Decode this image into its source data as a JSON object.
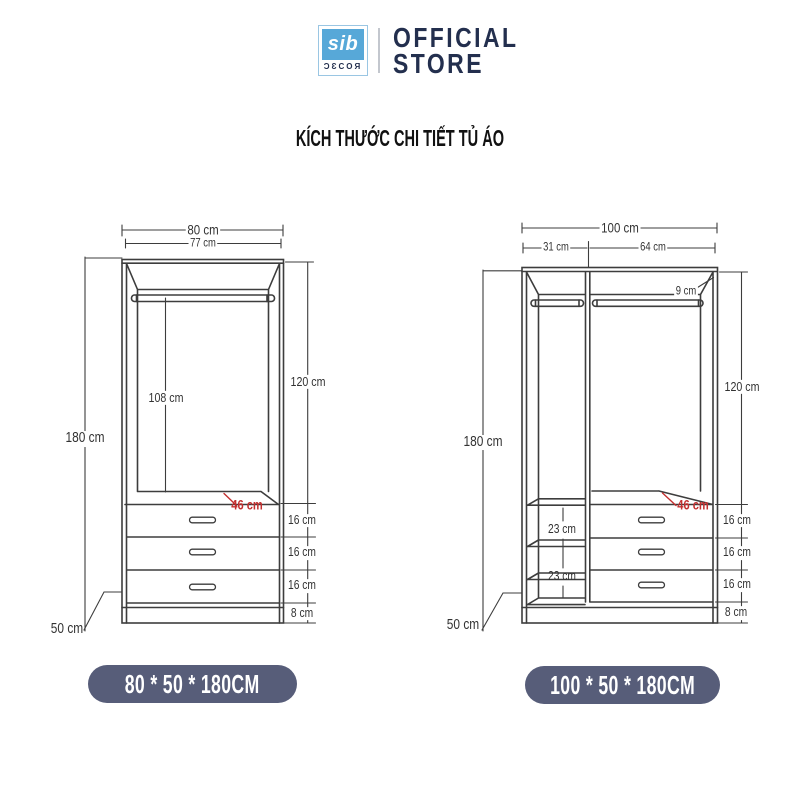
{
  "header": {
    "logo_text": "sib",
    "logo_subtext": "ƆƐCOЯ",
    "store_line1": "OFFICIAL",
    "store_line2": "STORE"
  },
  "title": "KÍCH THƯỚC CHI TIẾT TỦ ÁO",
  "colors": {
    "line": "#3d3d3d",
    "accent_red": "#c32f2f",
    "badge_bg": "#575d79",
    "badge_text": "#ffffff",
    "brand_navy": "#232f4e",
    "logo_blue": "#57a8d8"
  },
  "left": {
    "badge": "80 * 50 * 180CM",
    "width_outer": "80 cm",
    "width_inner": "77 cm",
    "height": "180 cm",
    "upper_height": "120 cm",
    "hanging_height": "108 cm",
    "depth": "50 cm",
    "top_depth": "46 cm",
    "drawers": [
      "16 cm",
      "16 cm",
      "16 cm"
    ],
    "base": "8 cm"
  },
  "right": {
    "badge": "100 * 50 * 180CM",
    "width_outer": "100 cm",
    "width_left": "31 cm",
    "width_right": "64 cm",
    "rail_gap": "9 cm",
    "height": "180 cm",
    "upper_height": "120 cm",
    "shelves": [
      "23 cm",
      "23 cm"
    ],
    "depth": "50 cm",
    "top_depth": "46 cm",
    "drawers": [
      "16 cm",
      "16 cm",
      "16 cm"
    ],
    "base": "8 cm"
  }
}
